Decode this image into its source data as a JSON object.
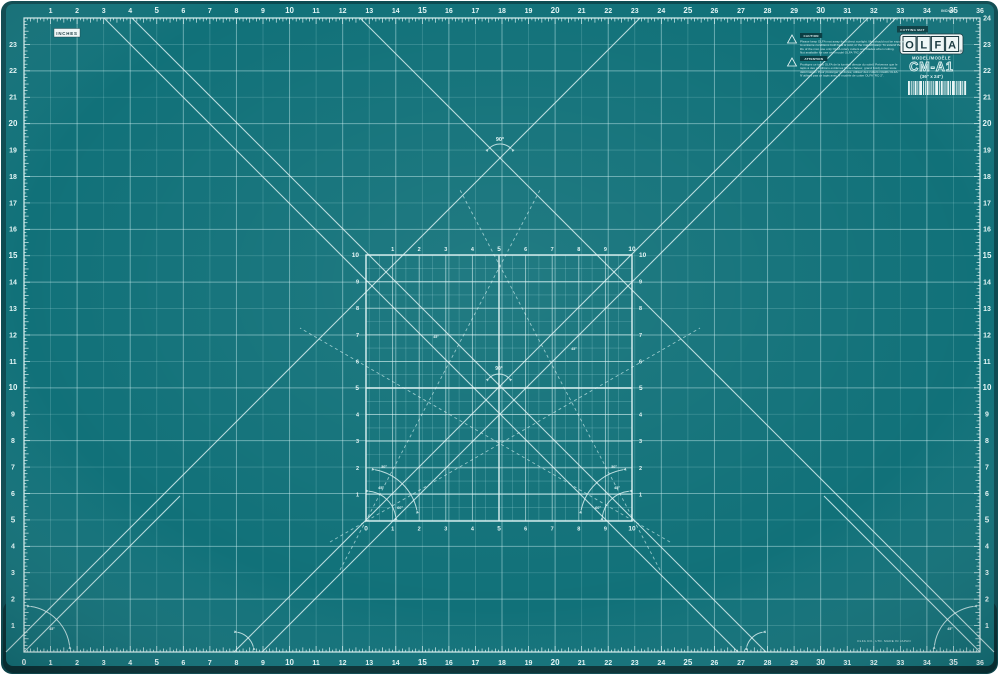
{
  "photo": {
    "background": "#ffffff"
  },
  "mat": {
    "unit_label": "INCHES",
    "unit_label_small": "INCHES",
    "brand_letters": [
      "O",
      "L",
      "F",
      "A"
    ],
    "reg_mark": "®",
    "chip_text": "CUTTING MAT",
    "model_label": "MODEL/MODÈLE",
    "model": "CM-A1",
    "size_label": "(36\" x 24\")",
    "fine_print": "OLFA CO., LTD. MADE IN JAPAN",
    "colors": {
      "face": "#117179",
      "rim": "#0b4a51",
      "rim_dark": "#072f34",
      "grid_minor": "rgba(190,235,238,0.22)",
      "grid_major": "rgba(208,241,243,0.45)",
      "bright": "#dcf2f2",
      "number": "#e4f6f6",
      "diagonal": "rgba(228,247,247,0.8)",
      "dashed": "rgba(215,242,243,0.65)",
      "cg_minor": "rgba(185,232,235,0.32)",
      "cg_major": "rgba(222,245,246,0.62)",
      "logo_bg": "#f2fafa",
      "logo_ink": "#14343b",
      "chip_bg": "#0a3e44",
      "chip_ink": "#eaf7f7",
      "micro_ink": "#cfeaea",
      "barcode": "#e8f6f6"
    },
    "rulers": {
      "top": [
        1,
        2,
        3,
        4,
        5,
        6,
        7,
        8,
        9,
        10,
        11,
        12,
        13,
        14,
        15,
        16,
        17,
        18,
        19,
        20,
        21,
        22,
        23,
        24,
        25,
        26,
        27,
        28,
        29,
        30,
        31,
        32,
        33,
        34,
        35,
        36
      ],
      "bottom": [
        0,
        1,
        2,
        3,
        4,
        5,
        6,
        7,
        8,
        9,
        10,
        11,
        12,
        13,
        14,
        15,
        16,
        17,
        18,
        19,
        20,
        21,
        22,
        23,
        24,
        25,
        26,
        27,
        28,
        29,
        30,
        31,
        32,
        33,
        34,
        35,
        36
      ],
      "left": [
        23,
        22,
        21,
        20,
        19,
        18,
        17,
        16,
        15,
        14,
        13,
        12,
        11,
        10,
        9,
        8,
        7,
        6,
        5,
        4,
        3,
        2,
        1
      ],
      "right": [
        24,
        23,
        22,
        21,
        20,
        19,
        18,
        17,
        16,
        15,
        14,
        13,
        12,
        11,
        10,
        9,
        8,
        7,
        6,
        5,
        4,
        3,
        2,
        1
      ]
    },
    "center_grid": {
      "bottom": [
        0,
        1,
        2,
        3,
        4,
        5,
        6,
        7,
        8,
        9,
        10
      ],
      "top": [
        1,
        2,
        3,
        4,
        5,
        6,
        7,
        8,
        9,
        10
      ],
      "left": [
        1,
        2,
        3,
        4,
        5,
        6,
        7,
        8,
        9,
        10
      ],
      "right": [
        1,
        2,
        3,
        4,
        5,
        6,
        7,
        8,
        9,
        10
      ]
    },
    "angles": {
      "upper": "90°",
      "center": "90°",
      "corner_left": [
        "30°",
        "45°",
        "60°"
      ],
      "corner_right": [
        "30°",
        "45°",
        "60°"
      ],
      "mid_left": "45°",
      "mid_right": "45°",
      "mat_bl": "45°",
      "mat_br": "45°"
    },
    "warnings": [
      {
        "header": "CAUTION",
        "lines": [
          "Please keep OLFA mat away from direct sunlight. Mat should not be exposed",
          "to extreme conditions both heat & cold, or the mat will warp. To extend the",
          "life of the mat, use only OLFA rotary cutters and blades when cutting.",
          "Not available for use with model OLFA \"RC-2\"."
        ]
      },
      {
        "header": "ATTENTION",
        "lines": [
          "Protégez ce tapis OLFA de la lumière directe du soleil. Prévenez que le",
          "tapis à des conditions extrêmes (forte chaleur, grand froid) évitez toute",
          "déformation. Pour prolonger sa durée, utilisez des cutters rotatifs OLFA.",
          "N'utilisez pas ce tapis avec le modèle de cutter OLFA \"RC-2\"."
        ]
      }
    ]
  }
}
